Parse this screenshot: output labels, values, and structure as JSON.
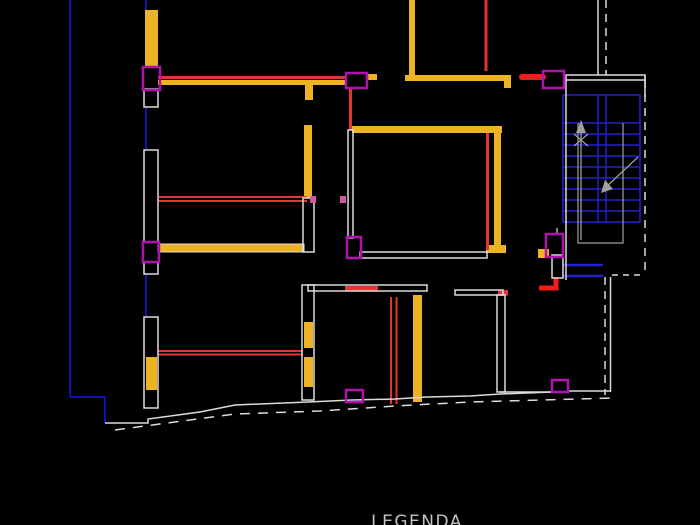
{
  "legend": {
    "title": "LEGENDA"
  },
  "palette": {
    "background": "#000000",
    "wall_outline": "#dcdcdc",
    "wall_yellow": "#eeb322",
    "wall_red": "#e43434",
    "bright_red": "#f31d1d",
    "door_magenta": "#b012b0",
    "hinge_pink": "#d1589f",
    "pipe_blue": "#0f0fb4",
    "stair_blue": "#2222cc",
    "stair_gray": "#9f9f9f",
    "text_gray": "#c4c4c4"
  },
  "drawing": {
    "width": 700,
    "height": 525,
    "layers": [
      {
        "name": "site-plumbing-lines",
        "color": "pipe_blue",
        "elements": [
          {
            "type": "line",
            "x1": 70,
            "y1": 0,
            "x2": 70,
            "y2": 397,
            "w": 2
          },
          {
            "type": "line",
            "x1": 70,
            "y1": 397,
            "x2": 105,
            "y2": 397,
            "w": 2
          },
          {
            "type": "line",
            "x1": 105,
            "y1": 397,
            "x2": 105,
            "y2": 423,
            "w": 2
          },
          {
            "type": "line",
            "x1": 146,
            "y1": 0,
            "x2": 146,
            "y2": 11,
            "w": 2
          },
          {
            "type": "line",
            "x1": 146,
            "y1": 107,
            "x2": 146,
            "y2": 150,
            "w": 2
          },
          {
            "type": "line",
            "x1": 146,
            "y1": 273,
            "x2": 146,
            "y2": 317,
            "w": 2
          }
        ]
      },
      {
        "name": "staircase-treads",
        "color": "stair_blue",
        "elements": [
          {
            "type": "rect",
            "x": 563,
            "y": 95,
            "w": 77,
            "h": 127,
            "mode": "stroke",
            "sw": 1.5
          },
          {
            "type": "line",
            "x1": 563,
            "y1": 123,
            "x2": 640,
            "y2": 123,
            "w": 1.5
          },
          {
            "type": "line",
            "x1": 563,
            "y1": 134,
            "x2": 640,
            "y2": 134,
            "w": 1.5
          },
          {
            "type": "line",
            "x1": 563,
            "y1": 145,
            "x2": 640,
            "y2": 145,
            "w": 1.5
          },
          {
            "type": "line",
            "x1": 563,
            "y1": 156,
            "x2": 640,
            "y2": 156,
            "w": 1.5
          },
          {
            "type": "line",
            "x1": 563,
            "y1": 167,
            "x2": 640,
            "y2": 167,
            "w": 1.5
          },
          {
            "type": "line",
            "x1": 563,
            "y1": 178,
            "x2": 640,
            "y2": 178,
            "w": 1.5
          },
          {
            "type": "line",
            "x1": 563,
            "y1": 189,
            "x2": 640,
            "y2": 189,
            "w": 1.5
          },
          {
            "type": "line",
            "x1": 563,
            "y1": 200,
            "x2": 640,
            "y2": 200,
            "w": 1.5
          },
          {
            "type": "line",
            "x1": 563,
            "y1": 211,
            "x2": 640,
            "y2": 211,
            "w": 1.5
          },
          {
            "type": "line",
            "x1": 598,
            "y1": 95,
            "x2": 598,
            "y2": 222,
            "w": 1.5
          },
          {
            "type": "line",
            "x1": 606,
            "y1": 95,
            "x2": 606,
            "y2": 222,
            "w": 1.5
          },
          {
            "type": "line",
            "x1": 563,
            "y1": 265,
            "x2": 603,
            "y2": 265,
            "w": 2.5
          },
          {
            "type": "line",
            "x1": 563,
            "y1": 276,
            "x2": 603,
            "y2": 276,
            "w": 2.5
          }
        ]
      },
      {
        "name": "yellow-walls",
        "color": "wall_yellow",
        "elements": [
          {
            "type": "rect",
            "x": 145,
            "y": 10,
            "w": 13,
            "h": 57,
            "mode": "fill"
          },
          {
            "type": "rect",
            "x": 146,
            "y": 357,
            "w": 11,
            "h": 33,
            "mode": "fill"
          },
          {
            "type": "rect",
            "x": 305,
            "y": 85,
            "w": 8,
            "h": 15,
            "mode": "fill"
          },
          {
            "type": "rect",
            "x": 304,
            "y": 125,
            "w": 8,
            "h": 73,
            "mode": "fill"
          },
          {
            "type": "rect",
            "x": 304,
            "y": 322,
            "w": 9,
            "h": 26,
            "mode": "fill"
          },
          {
            "type": "rect",
            "x": 304,
            "y": 357,
            "w": 9,
            "h": 30,
            "mode": "fill"
          },
          {
            "type": "rect",
            "x": 158,
            "y": 244,
            "w": 146,
            "h": 8,
            "mode": "fill",
            "stroke": "wall_outline",
            "sw": 1
          },
          {
            "type": "rect",
            "x": 158,
            "y": 80,
            "w": 189,
            "h": 5,
            "mode": "fill"
          },
          {
            "type": "rect",
            "x": 367,
            "y": 74,
            "w": 10,
            "h": 6,
            "mode": "fill"
          },
          {
            "type": "rect",
            "x": 409,
            "y": 0,
            "w": 6,
            "h": 75,
            "mode": "fill"
          },
          {
            "type": "rect",
            "x": 405,
            "y": 75,
            "w": 101,
            "h": 6,
            "mode": "fill"
          },
          {
            "type": "rect",
            "x": 504,
            "y": 75,
            "w": 7,
            "h": 13,
            "mode": "fill"
          },
          {
            "type": "rect",
            "x": 352,
            "y": 126,
            "w": 150,
            "h": 7,
            "mode": "fill"
          },
          {
            "type": "rect",
            "x": 494,
            "y": 133,
            "w": 7,
            "h": 112,
            "mode": "fill"
          },
          {
            "type": "rect",
            "x": 486,
            "y": 245,
            "w": 20,
            "h": 8,
            "mode": "fill"
          },
          {
            "type": "rect",
            "x": 538,
            "y": 249,
            "w": 11,
            "h": 9,
            "mode": "fill"
          },
          {
            "type": "rect",
            "x": 413,
            "y": 295,
            "w": 9,
            "h": 107,
            "mode": "fill"
          }
        ]
      },
      {
        "name": "red-walls",
        "color": "wall_red",
        "elements": [
          {
            "type": "line",
            "x1": 158,
            "y1": 77.5,
            "x2": 347,
            "y2": 77.5,
            "w": 3
          },
          {
            "type": "line",
            "x1": 159,
            "y1": 197,
            "x2": 307,
            "y2": 197,
            "w": 2
          },
          {
            "type": "line",
            "x1": 159,
            "y1": 201,
            "x2": 307,
            "y2": 201,
            "w": 2
          },
          {
            "type": "line",
            "x1": 158,
            "y1": 351,
            "x2": 303,
            "y2": 351,
            "w": 2
          },
          {
            "type": "line",
            "x1": 158,
            "y1": 354.5,
            "x2": 303,
            "y2": 354.5,
            "w": 2
          },
          {
            "type": "line",
            "x1": 486,
            "y1": 0,
            "x2": 486,
            "y2": 71,
            "w": 3
          },
          {
            "type": "line",
            "x1": 350.5,
            "y1": 88,
            "x2": 350.5,
            "y2": 130,
            "w": 3
          },
          {
            "type": "line",
            "x1": 487.5,
            "y1": 133,
            "x2": 487.5,
            "y2": 250,
            "w": 3
          },
          {
            "type": "line",
            "x1": 391,
            "y1": 297,
            "x2": 391,
            "y2": 404,
            "w": 2
          },
          {
            "type": "line",
            "x1": 396.5,
            "y1": 297,
            "x2": 396.5,
            "y2": 404,
            "w": 2
          },
          {
            "type": "rect",
            "x": 345,
            "y": 286,
            "w": 33,
            "h": 4.5,
            "mode": "fill"
          },
          {
            "type": "rect",
            "x": 498,
            "y": 290,
            "w": 10,
            "h": 5.5,
            "mode": "fill"
          },
          {
            "type": "line",
            "x1": 522,
            "y1": 77,
            "x2": 543,
            "y2": 77,
            "w": 6,
            "cap": "round",
            "c": "bright_red"
          },
          {
            "type": "polyline",
            "pts": [
              [
                556,
                277
              ],
              [
                556,
                288
              ],
              [
                539,
                288
              ]
            ],
            "w": 5,
            "c": "bright_red"
          }
        ]
      },
      {
        "name": "white-walls",
        "color": "wall_outline",
        "elements": [
          {
            "type": "rect",
            "x": 144,
            "y": 89,
            "w": 14,
            "h": 18,
            "mode": "stroke"
          },
          {
            "type": "rect",
            "x": 144,
            "y": 150,
            "w": 14,
            "h": 92,
            "mode": "stroke"
          },
          {
            "type": "rect",
            "x": 144,
            "y": 262,
            "w": 14,
            "h": 12,
            "mode": "stroke"
          },
          {
            "type": "rect",
            "x": 144,
            "y": 317,
            "w": 14,
            "h": 91,
            "mode": "stroke"
          },
          {
            "type": "rect",
            "x": 303,
            "y": 198,
            "w": 11,
            "h": 54,
            "mode": "stroke"
          },
          {
            "type": "rect",
            "x": 302,
            "y": 285,
            "w": 12,
            "h": 115,
            "mode": "stroke"
          },
          {
            "type": "rect",
            "x": 348,
            "y": 130,
            "w": 5,
            "h": 108,
            "mode": "stroke"
          },
          {
            "type": "rect",
            "x": 360,
            "y": 252,
            "w": 127,
            "h": 6,
            "mode": "stroke"
          },
          {
            "type": "rect",
            "x": 308,
            "y": 285,
            "w": 119,
            "h": 6,
            "mode": "stroke"
          },
          {
            "type": "rect",
            "x": 455,
            "y": 290,
            "w": 48,
            "h": 5,
            "mode": "stroke"
          },
          {
            "type": "rect",
            "x": 497,
            "y": 295,
            "w": 8,
            "h": 97,
            "mode": "stroke"
          },
          {
            "type": "rect",
            "x": 552,
            "y": 255,
            "w": 11,
            "h": 23,
            "mode": "stroke"
          },
          {
            "type": "rect",
            "x": 566,
            "y": 75,
            "w": 79,
            "h": 5,
            "mode": "stroke"
          },
          {
            "type": "line",
            "x1": 566,
            "y1": 80,
            "x2": 566,
            "y2": 280,
            "w": 1.5
          },
          {
            "type": "line",
            "x1": 598,
            "y1": 0,
            "x2": 598,
            "y2": 75,
            "w": 1.5
          },
          {
            "type": "line",
            "x1": 645,
            "y1": 75,
            "x2": 645,
            "y2": 97,
            "w": 1.5
          },
          {
            "type": "line",
            "x1": 610.5,
            "y1": 277,
            "x2": 610.5,
            "y2": 392,
            "w": 1.5
          },
          {
            "type": "line",
            "x1": 568,
            "y1": 391,
            "x2": 611,
            "y2": 391,
            "w": 1.5
          },
          {
            "type": "line",
            "x1": 500,
            "y1": 392,
            "x2": 552,
            "y2": 392,
            "w": 1.5
          },
          {
            "type": "line",
            "x1": 557,
            "y1": 228,
            "x2": 557,
            "y2": 234,
            "w": 1.2
          },
          {
            "type": "polyline",
            "pts": [
              [
                556,
                88
              ],
              [
                564,
                88
              ],
              [
                564,
                81
              ]
            ],
            "w": 1.2
          },
          {
            "type": "polyline",
            "pts": [
              [
                105,
                423
              ],
              [
                148,
                423
              ],
              [
                148,
                419
              ],
              [
                200,
                412
              ],
              [
                235,
                405
              ],
              [
                308,
                402
              ],
              [
                352,
                400
              ],
              [
                395,
                399
              ],
              [
                427,
                397
              ],
              [
                470,
                396
              ],
              [
                500,
                394
              ],
              [
                552,
                392
              ]
            ],
            "w": 1.5
          }
        ]
      },
      {
        "name": "dashed-boundary",
        "color": "wall_outline",
        "elements": [
          {
            "type": "line",
            "x1": 606,
            "y1": 0,
            "x2": 606,
            "y2": 75,
            "w": 1.5,
            "dash": "8 6"
          },
          {
            "type": "line",
            "x1": 645,
            "y1": 80,
            "x2": 645,
            "y2": 272,
            "w": 1.5,
            "dash": "8 6"
          },
          {
            "type": "line",
            "x1": 612,
            "y1": 275,
            "x2": 645,
            "y2": 275,
            "w": 1.5,
            "dash": "6 5"
          },
          {
            "type": "line",
            "x1": 605,
            "y1": 277,
            "x2": 605,
            "y2": 395,
            "w": 1.5,
            "dash": "8 6"
          },
          {
            "type": "polyline",
            "pts": [
              [
                115,
                430
              ],
              [
                235,
                414
              ],
              [
                320,
                411
              ],
              [
                395,
                406
              ],
              [
                470,
                402
              ],
              [
                615,
                398
              ]
            ],
            "w": 1.5,
            "dash": "10 8"
          }
        ]
      },
      {
        "name": "magenta-doors",
        "color": "door_magenta",
        "elements": [
          {
            "type": "rect",
            "x": 143,
            "y": 67,
            "w": 17,
            "h": 23,
            "mode": "stroke",
            "sw": 2.5
          },
          {
            "type": "rect",
            "x": 143,
            "y": 242,
            "w": 16,
            "h": 20,
            "mode": "stroke",
            "sw": 2.5
          },
          {
            "type": "rect",
            "x": 346,
            "y": 73,
            "w": 21,
            "h": 15,
            "mode": "stroke",
            "sw": 2.5
          },
          {
            "type": "rect",
            "x": 347,
            "y": 237,
            "w": 14,
            "h": 21,
            "mode": "stroke",
            "sw": 2.5
          },
          {
            "type": "rect",
            "x": 543,
            "y": 71,
            "w": 21,
            "h": 17,
            "mode": "stroke",
            "sw": 2.5
          },
          {
            "type": "rect",
            "x": 546,
            "y": 234,
            "w": 17,
            "h": 23,
            "mode": "stroke",
            "sw": 2.5
          },
          {
            "type": "rect",
            "x": 552,
            "y": 380,
            "w": 16,
            "h": 12,
            "mode": "stroke",
            "sw": 2.5
          },
          {
            "type": "rect",
            "x": 346,
            "y": 390,
            "w": 17,
            "h": 12,
            "mode": "stroke",
            "sw": 2.5
          }
        ]
      },
      {
        "name": "door-hinge-marks",
        "color": "hinge_pink",
        "elements": [
          {
            "type": "rect",
            "x": 310,
            "y": 196,
            "w": 6,
            "h": 7,
            "mode": "fill"
          },
          {
            "type": "rect",
            "x": 340,
            "y": 196,
            "w": 6,
            "h": 7,
            "mode": "fill"
          }
        ]
      },
      {
        "name": "stair-arrows",
        "color": "stair_gray",
        "elements": [
          {
            "type": "polyline",
            "pts": [
              [
                578,
                123
              ],
              [
                578,
                243
              ],
              [
                623,
                243
              ],
              [
                623,
                123
              ]
            ],
            "w": 1.2
          },
          {
            "type": "line",
            "x1": 581,
            "y1": 240,
            "x2": 581,
            "y2": 130,
            "w": 1.3
          },
          {
            "type": "polygon",
            "pts": [
              [
                581,
                120
              ],
              [
                576,
                133
              ],
              [
                586,
                133
              ]
            ]
          },
          {
            "type": "line",
            "x1": 574,
            "y1": 134,
            "x2": 588,
            "y2": 146,
            "w": 1.2
          },
          {
            "type": "line",
            "x1": 588,
            "y1": 134,
            "x2": 574,
            "y2": 146,
            "w": 1.2
          },
          {
            "type": "line",
            "x1": 638,
            "y1": 157,
            "x2": 604,
            "y2": 189,
            "w": 1.3
          },
          {
            "type": "polygon",
            "pts": [
              [
                601,
                193
              ],
              [
                613,
                189
              ],
              [
                605,
                180
              ]
            ]
          }
        ]
      }
    ]
  }
}
